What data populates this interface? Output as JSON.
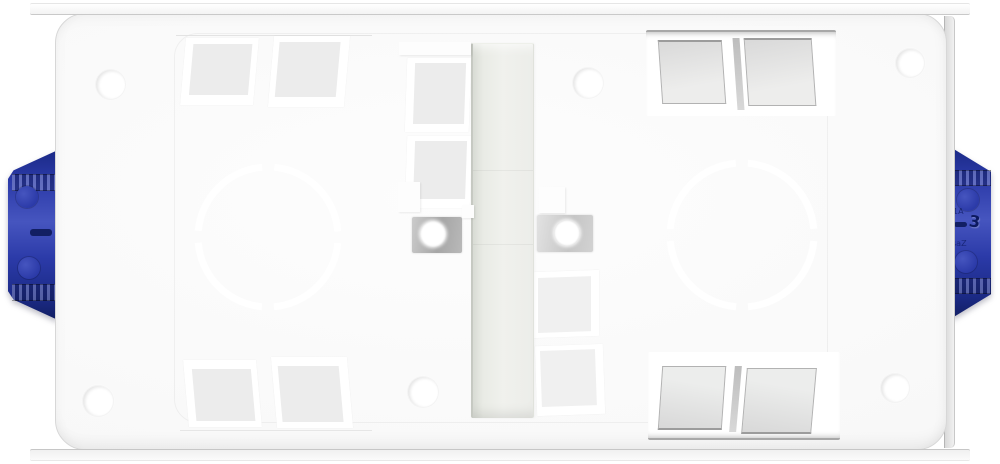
{
  "product": {
    "markings": {
      "right_clip": [
        "1A",
        "3",
        "saZ"
      ]
    }
  },
  "colors": {
    "page_bg": "#ffffff",
    "face": "#f8f8f8",
    "face_edge": "#d7d7d7",
    "knockout_fill": "#ececec",
    "knockout_fill_dark": "#d9d9d9",
    "channel_fill": "#ecede9",
    "channel_edge": "#c6c9c2",
    "lug_gray": "#a6a6a6",
    "clip_blue": "#2b3aa8",
    "clip_blue_light": "#4655bf",
    "clip_blue_dark": "#1b2a86",
    "clip_blue_deep": "#121f63"
  }
}
